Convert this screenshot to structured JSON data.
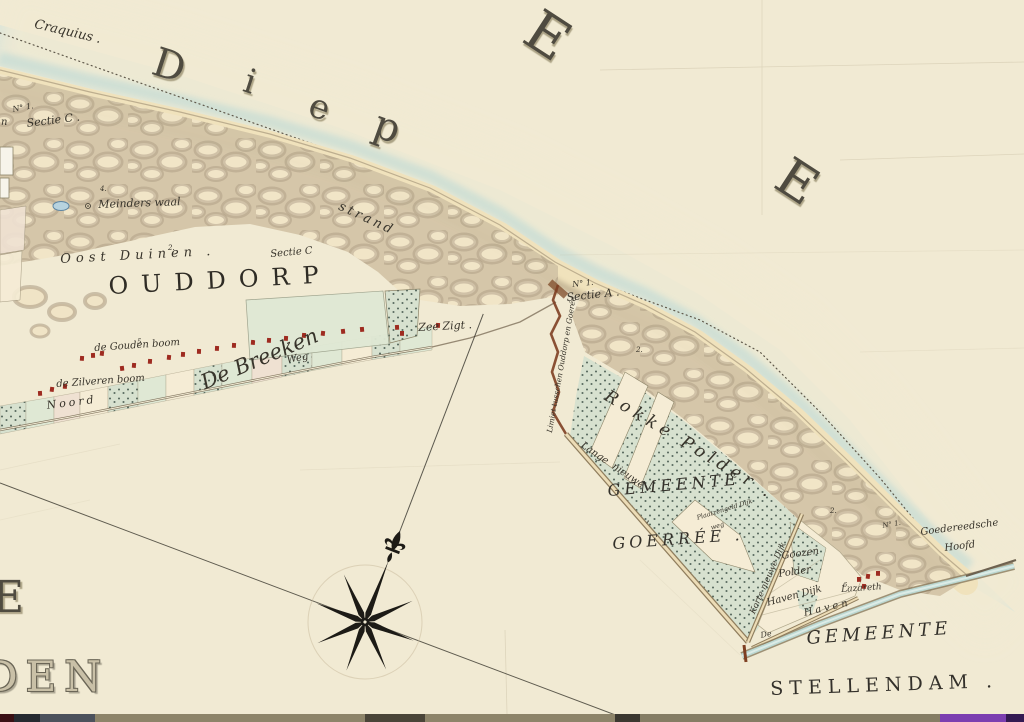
{
  "palette": {
    "paper": "#f1ead3",
    "paper2": "#f5ecd5",
    "water": "#cfe2dc",
    "waterDeep": "#c2dbd5",
    "sand": "#f0e2bc",
    "dune": "#d3c4a6",
    "duneLight": "#f0e4c6",
    "duneDark": "#a3927a",
    "duneEdge": "#93826a",
    "green": "#dfe8d4",
    "pink": "#efe1d2",
    "stipBase": "#d7e1cf",
    "stipDot": "#41544a",
    "red": "#9e2b20",
    "dike": "#8f7d5d",
    "dikeFill": "#ecdcb6",
    "limiet": "#7e3f22",
    "ink": "#38342b",
    "dotline": "#5f584a",
    "purple": "#7c3fb0"
  },
  "labels": [
    {
      "id": "craquius",
      "t": "Craquius .",
      "x": 36,
      "y": 18,
      "s": 13,
      "r": 13,
      "c": "it"
    },
    {
      "id": "diep-d",
      "t": "D",
      "x": 160,
      "y": 42,
      "s": 40,
      "r": 18,
      "c": "sea"
    },
    {
      "id": "diep-i",
      "t": "i",
      "x": 250,
      "y": 64,
      "s": 34,
      "r": 18,
      "c": "sea"
    },
    {
      "id": "diep-e",
      "t": "e",
      "x": 316,
      "y": 88,
      "s": 34,
      "r": 20,
      "c": "sea"
    },
    {
      "id": "diep-p",
      "t": "p",
      "x": 382,
      "y": 104,
      "s": 40,
      "r": 20,
      "c": "sea"
    },
    {
      "id": "sea-letter-e1",
      "t": "E",
      "x": 545,
      "y": 2,
      "s": 56,
      "r": 33,
      "c": "sea"
    },
    {
      "id": "sea-letter-e2",
      "t": "E",
      "x": 795,
      "y": 150,
      "s": 52,
      "r": 33,
      "c": "sea"
    },
    {
      "id": "partial-letter",
      "t": "n",
      "x": 1,
      "y": 118,
      "s": 10,
      "r": 0,
      "c": "it"
    },
    {
      "id": "no1-left",
      "t": "N° 1.",
      "x": 12,
      "y": 106,
      "s": 8,
      "r": -10,
      "c": "it"
    },
    {
      "id": "sectie-c-left",
      "t": "Sectie C .",
      "x": 26,
      "y": 118,
      "s": 11,
      "r": -7,
      "c": "it"
    },
    {
      "id": "num-4",
      "t": "4.",
      "x": 100,
      "y": 186,
      "s": 7,
      "r": 0,
      "c": "it"
    },
    {
      "id": "meinders-waal",
      "t": "Meinders waal",
      "x": 98,
      "y": 199,
      "s": 11,
      "r": -2,
      "c": "it"
    },
    {
      "id": "oost-duinen",
      "t": "Oost Duinen .",
      "x": 60,
      "y": 253,
      "s": 13,
      "r": -3,
      "c": "itsp"
    },
    {
      "id": "num-2a",
      "t": "2.",
      "x": 168,
      "y": 245,
      "s": 7,
      "r": 0,
      "c": "it"
    },
    {
      "id": "sectie-c-right",
      "t": "Sectie C",
      "x": 270,
      "y": 250,
      "s": 10,
      "r": -5,
      "c": "it"
    },
    {
      "id": "ouddorp",
      "t": "OUDDORP",
      "x": 108,
      "y": 274,
      "s": 24,
      "r": -3,
      "c": "capsp"
    },
    {
      "id": "strand",
      "t": "strand",
      "x": 342,
      "y": 200,
      "s": 13,
      "r": 25,
      "c": "itsp2"
    },
    {
      "id": "zee-zigt",
      "t": "Zee Zigt .",
      "x": 418,
      "y": 322,
      "s": 11,
      "r": -3,
      "c": "it"
    },
    {
      "id": "num-5",
      "t": "5",
      "x": 137,
      "y": 339,
      "s": 7,
      "r": 0,
      "c": "it"
    },
    {
      "id": "gouden-boom",
      "t": "de Gouden boom",
      "x": 94,
      "y": 344,
      "s": 10,
      "r": -4,
      "c": "it"
    },
    {
      "id": "zilveren-boom",
      "t": "de Zilveren boom",
      "x": 56,
      "y": 380,
      "s": 10,
      "r": -4,
      "c": "it"
    },
    {
      "id": "noord",
      "t": "Noord",
      "x": 46,
      "y": 400,
      "s": 11,
      "r": -7,
      "c": "itsp2"
    },
    {
      "id": "de-breeken",
      "t": "De Breeken",
      "x": 198,
      "y": 374,
      "s": 21,
      "r": -23,
      "c": "it"
    },
    {
      "id": "weg",
      "t": "Weg",
      "x": 286,
      "y": 356,
      "s": 10,
      "r": -10,
      "c": "it"
    },
    {
      "id": "no1-sectie-a",
      "t": "N° 1.",
      "x": 572,
      "y": 281,
      "s": 8,
      "r": -6,
      "c": "it"
    },
    {
      "id": "sectie-a",
      "t": "Sectie A .",
      "x": 566,
      "y": 292,
      "s": 11,
      "r": -6,
      "c": "it"
    },
    {
      "id": "limiet-tusschen",
      "t": "Limiet tusschen Ouddorp en Goerée",
      "x": 546,
      "y": 432,
      "s": 7.5,
      "r": -80,
      "c": "it"
    },
    {
      "id": "num-2b",
      "t": "2.",
      "x": 636,
      "y": 347,
      "s": 7,
      "r": 0,
      "c": "it"
    },
    {
      "id": "rokke-polder",
      "t": "Rokke Polder .",
      "x": 610,
      "y": 388,
      "s": 17,
      "r": 31,
      "c": "itsp"
    },
    {
      "id": "lange-nieuwe-dijk",
      "t": "Lange  nieuwe",
      "x": 584,
      "y": 441,
      "s": 10,
      "r": 34,
      "c": "it"
    },
    {
      "id": "gemeente-goerree-1",
      "t": "GEMEENTE",
      "x": 607,
      "y": 483,
      "s": 16,
      "r": -5,
      "c": "capit"
    },
    {
      "id": "comma",
      "t": ",",
      "x": 646,
      "y": 512,
      "s": 12,
      "r": 0,
      "c": "it"
    },
    {
      "id": "gemeente-goerree-2",
      "t": "GOERRÉE .",
      "x": 612,
      "y": 536,
      "s": 16,
      "r": -4,
      "c": "capit"
    },
    {
      "id": "plaatzengeld-1",
      "t": "Plaatzengeld Dijk",
      "x": 696,
      "y": 515,
      "s": 6.5,
      "r": -17,
      "c": "it"
    },
    {
      "id": "plaatzengeld-2",
      "t": "weg",
      "x": 710,
      "y": 525,
      "s": 6.5,
      "r": -17,
      "c": "it"
    },
    {
      "id": "korte-nieuwe-dijk",
      "t": "Korte nieuwe Dijk",
      "x": 749,
      "y": 612,
      "s": 8.5,
      "r": -66,
      "c": "it"
    },
    {
      "id": "goozen",
      "t": "Goozen",
      "x": 781,
      "y": 552,
      "s": 10,
      "r": -8,
      "c": "it"
    },
    {
      "id": "goozen-polder",
      "t": "Polder",
      "x": 778,
      "y": 570,
      "s": 10,
      "r": -8,
      "c": "it"
    },
    {
      "id": "haven-dijk",
      "t": "Haven Dijk",
      "x": 766,
      "y": 599,
      "s": 10,
      "r": -15,
      "c": "it"
    },
    {
      "id": "lazareth",
      "t": "Lazareth",
      "x": 841,
      "y": 586,
      "s": 9,
      "r": -4,
      "c": "it"
    },
    {
      "id": "num-6",
      "t": "6.",
      "x": 843,
      "y": 582,
      "s": 6.5,
      "r": 0,
      "c": "it"
    },
    {
      "id": "de-haven-de",
      "t": "De",
      "x": 760,
      "y": 632,
      "s": 8,
      "r": -10,
      "c": "it"
    },
    {
      "id": "de-haven",
      "t": "Haven",
      "x": 803,
      "y": 609,
      "s": 10,
      "r": -13,
      "c": "itsp2"
    },
    {
      "id": "num-2c",
      "t": "2.",
      "x": 830,
      "y": 508,
      "s": 7,
      "r": 0,
      "c": "it"
    },
    {
      "id": "no1-point",
      "t": "N° 1.",
      "x": 882,
      "y": 523,
      "s": 7,
      "r": -10,
      "c": "it"
    },
    {
      "id": "goedereedsche",
      "t": "Goedereedsche",
      "x": 920,
      "y": 528,
      "s": 10,
      "r": -7,
      "c": "it"
    },
    {
      "id": "hoofd",
      "t": "Hoofd",
      "x": 944,
      "y": 544,
      "s": 10,
      "r": -7,
      "c": "it"
    },
    {
      "id": "gemeente-stellendam-1",
      "t": "GEMEENTE",
      "x": 806,
      "y": 630,
      "s": 18,
      "r": -4,
      "c": "capit"
    },
    {
      "id": "gemeente-stellendam-2",
      "t": "STELLENDAM .",
      "x": 770,
      "y": 680,
      "s": 19,
      "r": -2,
      "c": "caps"
    },
    {
      "id": "sea-letter-e-left",
      "t": "E",
      "x": -8,
      "y": 576,
      "s": 44,
      "r": 0,
      "c": "sea"
    },
    {
      "id": "big-den",
      "t": "DEN",
      "x": -16,
      "y": 656,
      "s": 42,
      "r": 0,
      "c": "outline"
    }
  ],
  "map": {
    "houses": [
      [
        38,
        391
      ],
      [
        50,
        387
      ],
      [
        63,
        384
      ],
      [
        80,
        356
      ],
      [
        91,
        353
      ],
      [
        100,
        351
      ],
      [
        120,
        366
      ],
      [
        132,
        363
      ],
      [
        148,
        359
      ],
      [
        167,
        355
      ],
      [
        181,
        352
      ],
      [
        197,
        349
      ],
      [
        215,
        346
      ],
      [
        232,
        343
      ],
      [
        251,
        340
      ],
      [
        267,
        338
      ],
      [
        284,
        336
      ],
      [
        302,
        333
      ],
      [
        321,
        331
      ],
      [
        341,
        329
      ],
      [
        360,
        327
      ],
      [
        395,
        325
      ],
      [
        400,
        331
      ],
      [
        436,
        323
      ],
      [
        857,
        577
      ],
      [
        866,
        574
      ],
      [
        876,
        571
      ],
      [
        862,
        584
      ]
    ],
    "village_band": {
      "top": [
        [
          0,
          406
        ],
        [
          70,
          394
        ],
        [
          150,
          378
        ],
        [
          230,
          362
        ],
        [
          310,
          347
        ],
        [
          370,
          337
        ],
        [
          432,
          326
        ]
      ],
      "bottom": [
        [
          0,
          434
        ],
        [
          70,
          420
        ],
        [
          150,
          404
        ],
        [
          230,
          388
        ],
        [
          310,
          371
        ],
        [
          370,
          360
        ],
        [
          432,
          350
        ]
      ],
      "parcels": [
        [
          0,
          26,
          "dots"
        ],
        [
          26,
          54,
          "green"
        ],
        [
          54,
          80,
          "pink"
        ],
        [
          80,
          108,
          "paper"
        ],
        [
          108,
          138,
          "dots"
        ],
        [
          138,
          166,
          "green"
        ],
        [
          166,
          194,
          "paper"
        ],
        [
          194,
          222,
          "dots"
        ],
        [
          222,
          252,
          "green"
        ],
        [
          252,
          282,
          "pink"
        ],
        [
          282,
          312,
          "dots"
        ],
        [
          312,
          342,
          "green"
        ],
        [
          342,
          372,
          "paper"
        ],
        [
          372,
          400,
          "dots"
        ],
        [
          400,
          432,
          "green"
        ]
      ]
    },
    "bottom_strip": [
      [
        0,
        14,
        "#3a1014"
      ],
      [
        14,
        26,
        "#262a30"
      ],
      [
        40,
        55,
        "#4c525c"
      ],
      [
        95,
        270,
        "#8d8469"
      ],
      [
        365,
        60,
        "#4a4538"
      ],
      [
        425,
        190,
        "#8d8469"
      ],
      [
        615,
        25,
        "#3c3830"
      ],
      [
        640,
        300,
        "#857d64"
      ],
      [
        940,
        66,
        "#7c3fb0"
      ],
      [
        1006,
        18,
        "#341a52"
      ]
    ]
  }
}
